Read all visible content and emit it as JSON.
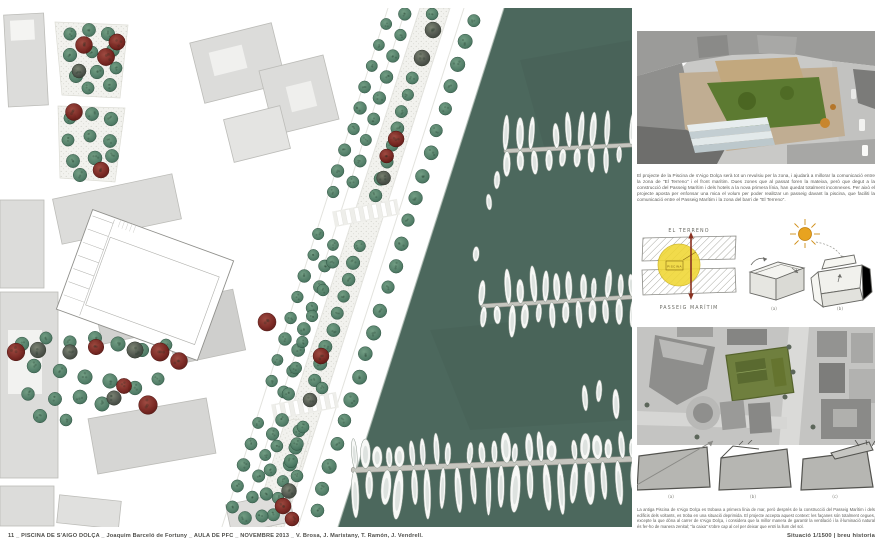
{
  "footer": {
    "left": "11 _ PISCINA DE S'AIGO DOLÇA _ Joaquim Barceló de Fortuny _ AULA DE PFC _ NOVEMBRE 2013 _ V. Brosa, J. Maristany, T. Ramón, J. Vendrell.",
    "right": "Situació 1/1500 | breu historia"
  },
  "right_column": {
    "intro_text": "El projecte de la Piscina de s'Aigo Dolça serà tot un revulsiu per la zona, i ajudarà a millorar la comunicació entre la zona de \"El Terreno\" i el front marítim. Dues zones que al passat foren la mateixa, però que degut a la construcció del Passeig Marítim i dels hotels a la nova primera línia, han quedat totalment inconnexes. Per això el projecte aposta per enfonsar una mica el volum per poder realitzar un passeig davant la piscina, que faciliti la comunicació entre el Passeig Marítim i la zona del barri de \"El Terreno\".",
    "site_diagram": {
      "top_label": "EL TERRENO",
      "bottom_label": "PASSEIG MARÍTIM",
      "circle_label": "PISCINA"
    },
    "concept_boxes": {
      "labels": [
        "(a)",
        "(b)"
      ]
    },
    "section_sketches": {
      "labels": [
        "(a)",
        "(b)",
        "(c)"
      ]
    },
    "history_text": "La antiga Piscina de s'Aigo Dolça es trobava a primera línia de mar, però després de la construcció del Passeig Marítim i dels edificis dels voltants, es troba en una situació deprimida. El projecte accepta aquest context: les façanes són totalment cegues, excepte la que dóna al carrer de s'Aigo Dolça, i considera que la millor manera de garantir la ventilació i la il·luminació natural és fer-ho de manera zenital; \"la caixa\" s'obre cap al cel per deixar que entri la llum del sol."
  },
  "colors": {
    "water": "#4c685d",
    "tree_green": "#4e7b65",
    "tree_red": "#77241f",
    "tree_dark": "#4c524a",
    "building": "#dcdcda",
    "highlight_yellow": "#f0d733",
    "sun_orange": "#e8a31f",
    "arrow_red": "#8a3222"
  }
}
